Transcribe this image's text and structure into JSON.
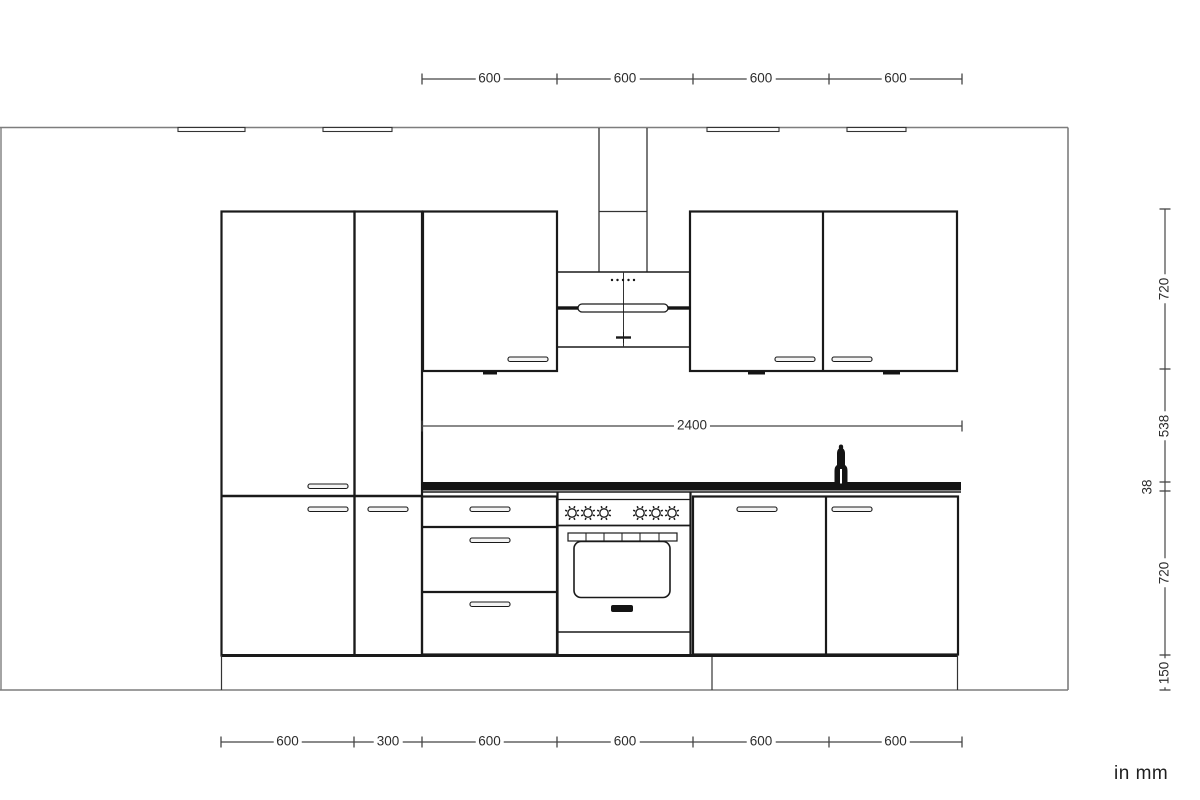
{
  "units_label": "in mm",
  "palette": {
    "ink": "#141414",
    "edge": "#1a1a1a",
    "thin": "#333333",
    "gray": "#7d7d7d",
    "dim": "#454545",
    "paper": "#ffffff",
    "handle_fill": "#f4f4f4"
  },
  "units_label_pos": {
    "x": 1114,
    "y": 763
  },
  "dims": {
    "top_chain": {
      "orient": "h",
      "pos": 79,
      "ticks": [
        422,
        557,
        693,
        829,
        962
      ],
      "labels": [
        {
          "text": "600",
          "at": 489.5
        },
        {
          "text": "600",
          "at": 625
        },
        {
          "text": "600",
          "at": 761
        },
        {
          "text": "600",
          "at": 895.5
        }
      ]
    },
    "worktop_run_width": {
      "orient": "h",
      "pos": 426,
      "ticks": [
        422,
        962
      ],
      "labels": [
        {
          "text": "2400",
          "at": 692
        }
      ]
    },
    "bottom_chain": {
      "orient": "h",
      "pos": 742,
      "ticks": [
        221,
        354,
        422,
        557,
        693,
        829,
        962
      ],
      "labels": [
        {
          "text": "600",
          "at": 287.5
        },
        {
          "text": "300",
          "at": 388
        },
        {
          "text": "600",
          "at": 489.5
        },
        {
          "text": "600",
          "at": 625
        },
        {
          "text": "600",
          "at": 761
        },
        {
          "text": "600",
          "at": 895.5
        }
      ]
    },
    "right_chain": {
      "orient": "v",
      "pos": 1165,
      "ticks": [
        209,
        369,
        482,
        491,
        655,
        690
      ],
      "labels": [
        {
          "text": "720",
          "at": 289
        },
        {
          "text": "538",
          "at": 425.5
        },
        {
          "text": "38",
          "at": 486.5,
          "off": -17
        },
        {
          "text": "720",
          "at": 573
        },
        {
          "text": "150",
          "at": 672.5
        }
      ]
    }
  },
  "drawing": {
    "shapes": [
      {
        "n": "wall-top-line",
        "t": "l",
        "x1": 0,
        "y1": 127.5,
        "x2": 1068,
        "y2": 127.5,
        "w": 1.6,
        "c": "gray"
      },
      {
        "n": "room-left-edge",
        "t": "l",
        "x1": 1,
        "y1": 127.5,
        "x2": 1,
        "y2": 690,
        "w": 1.4,
        "c": "gray"
      },
      {
        "n": "wall-right-line",
        "t": "l",
        "x1": 1068,
        "y1": 127.5,
        "x2": 1068,
        "y2": 690,
        "w": 1.6,
        "c": "gray"
      },
      {
        "n": "floor-line",
        "t": "l",
        "x1": 0,
        "y1": 690,
        "x2": 1068,
        "y2": 690,
        "w": 1.6,
        "c": "gray"
      },
      {
        "n": "wall-rail",
        "t": "r",
        "x": 178,
        "y": 127.5,
        "w": 67,
        "h": 4,
        "s": 1,
        "sw": 1.1,
        "c": "thin",
        "f": "paper"
      },
      {
        "n": "wall-rail",
        "t": "r",
        "x": 323,
        "y": 127.5,
        "w": 69,
        "h": 4,
        "s": 1,
        "sw": 1.1,
        "c": "thin",
        "f": "paper"
      },
      {
        "n": "wall-rail",
        "t": "r",
        "x": 707,
        "y": 127.5,
        "w": 72,
        "h": 4,
        "s": 1,
        "sw": 1.1,
        "c": "thin",
        "f": "paper"
      },
      {
        "n": "wall-rail",
        "t": "r",
        "x": 847,
        "y": 127.5,
        "w": 59,
        "h": 4,
        "s": 1,
        "sw": 1.1,
        "c": "thin",
        "f": "paper"
      },
      {
        "n": "tall-cabinet-left",
        "t": "r",
        "x": 221.5,
        "y": 211.5,
        "w": 133,
        "h": 444,
        "s": 1,
        "sw": 2.2
      },
      {
        "n": "tall-cabinet-narrow",
        "t": "r",
        "x": 354.5,
        "y": 211.5,
        "w": 67.5,
        "h": 444,
        "s": 1,
        "sw": 2.2
      },
      {
        "n": "tall-cabinet-door-split",
        "t": "l",
        "x1": 221.5,
        "y1": 496,
        "x2": 422,
        "y2": 496,
        "w": 2.6
      },
      {
        "n": "wall-cabinet-left",
        "t": "r",
        "x": 423,
        "y": 211.5,
        "w": 134,
        "h": 159.5,
        "s": 1,
        "sw": 2.2
      },
      {
        "n": "wall-cabinet-right",
        "t": "r",
        "x": 690,
        "y": 211.5,
        "w": 267,
        "h": 159.5,
        "s": 1,
        "sw": 2.2
      },
      {
        "n": "wall-cabinet-right-divider",
        "t": "l",
        "x1": 823,
        "y1": 211.5,
        "x2": 823,
        "y2": 371,
        "w": 2.2
      },
      {
        "n": "under-cabinet-light",
        "t": "r",
        "x": 483,
        "y": 371,
        "w": 14,
        "h": 3.5,
        "f": "ink"
      },
      {
        "n": "under-cabinet-light",
        "t": "r",
        "x": 748,
        "y": 371,
        "w": 17,
        "h": 3.5,
        "f": "ink"
      },
      {
        "n": "under-cabinet-light",
        "t": "r",
        "x": 883,
        "y": 371,
        "w": 17,
        "h": 3.5,
        "f": "ink"
      },
      {
        "n": "hood-chimney-left-edge",
        "t": "l",
        "x1": 599,
        "y1": 128,
        "x2": 599,
        "y2": 272,
        "w": 1.3,
        "c": "thin"
      },
      {
        "n": "hood-chimney-right-edge",
        "t": "l",
        "x1": 647,
        "y1": 128,
        "x2": 647,
        "y2": 272,
        "w": 1.3,
        "c": "thin"
      },
      {
        "n": "hood-chimney-joint",
        "t": "l",
        "x1": 599,
        "y1": 211.5,
        "x2": 647,
        "y2": 211.5,
        "w": 1.3,
        "c": "thin"
      },
      {
        "n": "hood-canopy-top",
        "t": "l",
        "x1": 557,
        "y1": 272,
        "x2": 690,
        "y2": 272,
        "w": 1.6
      },
      {
        "n": "hood-canopy-bottom",
        "t": "l",
        "x1": 557,
        "y1": 347,
        "x2": 690,
        "y2": 347,
        "w": 1.6
      },
      {
        "n": "hood-center-line",
        "t": "l",
        "x1": 623.5,
        "y1": 272,
        "x2": 623.5,
        "y2": 347,
        "w": 1,
        "c": "thin"
      },
      {
        "n": "hood-control-dots",
        "t": "dots",
        "cx": [
          612,
          617.5,
          623,
          628.5,
          634
        ],
        "cy": 280,
        "r": 1.2
      },
      {
        "n": "hood-lamp",
        "t": "r",
        "x": 578,
        "y": 304,
        "w": 90,
        "h": 8,
        "rx": 4,
        "s": 1,
        "sw": 1.3
      },
      {
        "n": "hood-lamp-side-bar",
        "t": "r",
        "x": 557,
        "y": 306.3,
        "w": 21,
        "h": 3.4,
        "f": "ink"
      },
      {
        "n": "hood-lamp-side-bar",
        "t": "r",
        "x": 668,
        "y": 306.3,
        "w": 22.5,
        "h": 3.4,
        "f": "ink"
      },
      {
        "n": "hood-bottom-mark-h",
        "t": "l",
        "x1": 616,
        "y1": 337.5,
        "x2": 631,
        "y2": 337.5,
        "w": 2.4
      },
      {
        "n": "hood-bottom-mark-v",
        "t": "l",
        "x1": 623.5,
        "y1": 332,
        "x2": 623.5,
        "y2": 343,
        "w": 1
      },
      {
        "n": "worktop",
        "t": "r",
        "x": 421,
        "y": 482,
        "w": 540,
        "h": 8.5,
        "f": "ink"
      },
      {
        "n": "worktop-front-edge",
        "t": "l",
        "x1": 421,
        "y1": 492,
        "x2": 961,
        "y2": 492,
        "w": 1.4
      },
      {
        "n": "faucet",
        "t": "p",
        "d": "M834.5 483.5 L834.5 471 Q834.5 466.5 837 465 L837 453.5 Q837 450 839 448.5 Q838.2 444.5 841 444.5 Q843.8 444.5 843 448.5 Q845 450 845 453.5 L845 465 Q847.5 466.5 847.5 471 L847.5 483.5 Z",
        "f": "ink"
      },
      {
        "n": "faucet-slit",
        "t": "r",
        "x": 840,
        "y": 469,
        "w": 2,
        "h": 14.5,
        "f": "paper"
      },
      {
        "n": "drawer-base-unit",
        "t": "r",
        "x": 422,
        "y": 496.5,
        "w": 135,
        "h": 158,
        "s": 1,
        "sw": 2.2
      },
      {
        "n": "drawer-divider",
        "t": "l",
        "x1": 422,
        "y1": 527,
        "x2": 557,
        "y2": 527,
        "w": 2.2
      },
      {
        "n": "drawer-divider",
        "t": "l",
        "x1": 422,
        "y1": 592,
        "x2": 557,
        "y2": 592,
        "w": 2.2
      },
      {
        "n": "range-left-side",
        "t": "l",
        "x1": 557.5,
        "y1": 492,
        "x2": 557.5,
        "y2": 654.5,
        "w": 2.2
      },
      {
        "n": "range-right-side",
        "t": "l",
        "x1": 690.5,
        "y1": 492,
        "x2": 690.5,
        "y2": 654.5,
        "w": 2.2
      },
      {
        "n": "range-panel-top",
        "t": "l",
        "x1": 557,
        "y1": 499.5,
        "x2": 691,
        "y2": 499.5,
        "w": 1.3
      },
      {
        "n": "range-panel-bottom",
        "t": "l",
        "x1": 557,
        "y1": 525.5,
        "x2": 691,
        "y2": 525.5,
        "w": 1.8
      },
      {
        "n": "burner-knob",
        "t": "knob",
        "x": 572,
        "y": 513,
        "r": 4.2
      },
      {
        "n": "burner-knob",
        "t": "knob",
        "x": 588,
        "y": 513,
        "r": 4.2
      },
      {
        "n": "burner-knob",
        "t": "knob",
        "x": 604,
        "y": 513,
        "r": 4.2
      },
      {
        "n": "burner-knob",
        "t": "knob",
        "x": 640,
        "y": 513,
        "r": 4.2
      },
      {
        "n": "burner-knob",
        "t": "knob",
        "x": 656,
        "y": 513,
        "r": 4.2
      },
      {
        "n": "burner-knob",
        "t": "knob",
        "x": 672,
        "y": 513,
        "r": 4.2
      },
      {
        "n": "oven-vent",
        "t": "r",
        "x": 568,
        "y": 533,
        "w": 109,
        "h": 8,
        "s": 1,
        "sw": 1.2
      },
      {
        "n": "oven-vent-divider",
        "t": "l",
        "x1": 586,
        "y1": 533,
        "x2": 586,
        "y2": 541,
        "w": 1
      },
      {
        "n": "oven-vent-divider",
        "t": "l",
        "x1": 604,
        "y1": 533,
        "x2": 604,
        "y2": 541,
        "w": 1
      },
      {
        "n": "oven-vent-divider",
        "t": "l",
        "x1": 622,
        "y1": 533,
        "x2": 622,
        "y2": 541,
        "w": 1
      },
      {
        "n": "oven-vent-divider",
        "t": "l",
        "x1": 640,
        "y1": 533,
        "x2": 640,
        "y2": 541,
        "w": 1
      },
      {
        "n": "oven-vent-divider",
        "t": "l",
        "x1": 659,
        "y1": 533,
        "x2": 659,
        "y2": 541,
        "w": 1
      },
      {
        "n": "oven-window",
        "t": "r",
        "x": 574,
        "y": 541.5,
        "w": 96,
        "h": 56,
        "rx": 7,
        "s": 1,
        "sw": 1.6
      },
      {
        "n": "oven-badge",
        "t": "r",
        "x": 611,
        "y": 605,
        "w": 22,
        "h": 7,
        "rx": 2,
        "f": "ink"
      },
      {
        "n": "oven-door-bottom",
        "t": "l",
        "x1": 557,
        "y1": 632,
        "x2": 691,
        "y2": 632,
        "w": 1.6
      },
      {
        "n": "sink-base-unit",
        "t": "r",
        "x": 693,
        "y": 496.5,
        "w": 265,
        "h": 158,
        "s": 1,
        "sw": 2.2
      },
      {
        "n": "sink-base-divider",
        "t": "l",
        "x1": 826,
        "y1": 496.5,
        "x2": 826,
        "y2": 654.5,
        "w": 2.2
      },
      {
        "n": "base-bottom-line",
        "t": "l",
        "x1": 221.5,
        "y1": 655.5,
        "x2": 958,
        "y2": 655.5,
        "w": 3
      },
      {
        "n": "plinth-left-end",
        "t": "l",
        "x1": 221.5,
        "y1": 655,
        "x2": 221.5,
        "y2": 690,
        "w": 1.2,
        "c": "thin"
      },
      {
        "n": "plinth-joint",
        "t": "l",
        "x1": 712,
        "y1": 657,
        "x2": 712,
        "y2": 690,
        "w": 1.2,
        "c": "thin"
      },
      {
        "n": "plinth-right-end",
        "t": "l",
        "x1": 957.5,
        "y1": 655,
        "x2": 957.5,
        "y2": 690,
        "w": 1.2,
        "c": "thin"
      },
      {
        "n": "door-handle",
        "t": "h",
        "x": 308,
        "y": 484
      },
      {
        "n": "door-handle",
        "t": "h",
        "x": 308,
        "y": 507
      },
      {
        "n": "door-handle",
        "t": "h",
        "x": 368,
        "y": 507
      },
      {
        "n": "door-handle",
        "t": "h",
        "x": 470,
        "y": 507
      },
      {
        "n": "door-handle",
        "t": "h",
        "x": 470,
        "y": 538
      },
      {
        "n": "door-handle",
        "t": "h",
        "x": 470,
        "y": 602
      },
      {
        "n": "door-handle",
        "t": "h",
        "x": 737,
        "y": 507
      },
      {
        "n": "door-handle",
        "t": "h",
        "x": 832,
        "y": 507
      },
      {
        "n": "door-handle",
        "t": "h",
        "x": 508,
        "y": 357
      },
      {
        "n": "door-handle",
        "t": "h",
        "x": 775,
        "y": 357
      },
      {
        "n": "door-handle",
        "t": "h",
        "x": 832,
        "y": 357
      }
    ]
  }
}
